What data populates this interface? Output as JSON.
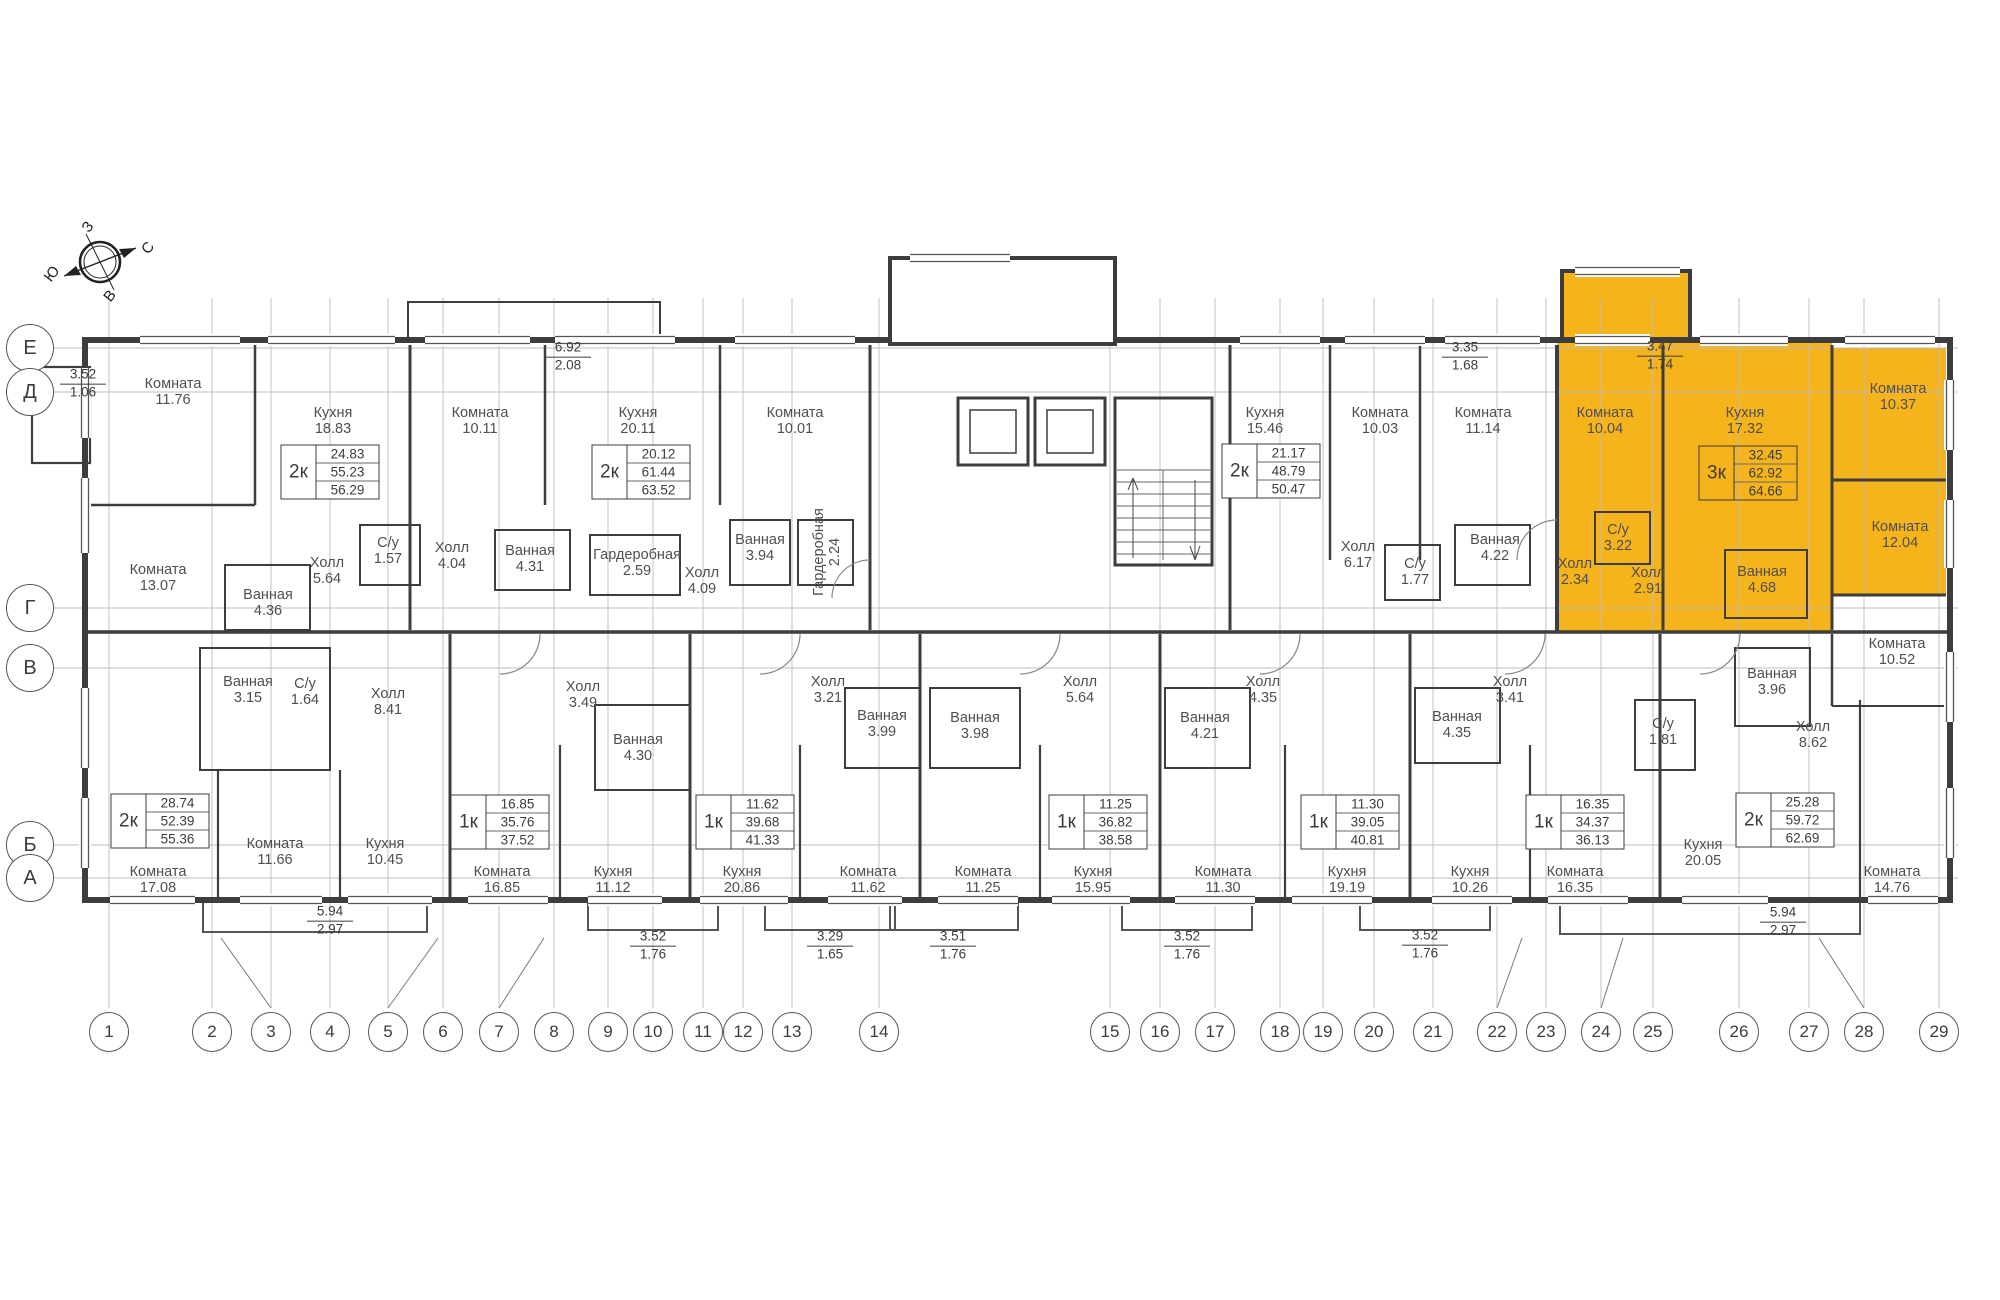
{
  "colors": {
    "highlight": "#F5B41C",
    "wall": "#3D3D3D",
    "grid": "#BDBDBD",
    "text": "#4F4F4F"
  },
  "compass": {
    "top": "З",
    "right": "С",
    "left": "Ю",
    "bottom": "В"
  },
  "row_axes": [
    {
      "label": "Е",
      "y": 348
    },
    {
      "label": "Д",
      "y": 392
    },
    {
      "label": "Г",
      "y": 608
    },
    {
      "label": "В",
      "y": 668
    },
    {
      "label": "Б",
      "y": 845
    },
    {
      "label": "А",
      "y": 878
    }
  ],
  "col_axes": [
    {
      "label": "1",
      "x": 109
    },
    {
      "label": "2",
      "x": 212
    },
    {
      "label": "3",
      "x": 271
    },
    {
      "label": "4",
      "x": 330
    },
    {
      "label": "5",
      "x": 388
    },
    {
      "label": "6",
      "x": 443
    },
    {
      "label": "7",
      "x": 499
    },
    {
      "label": "8",
      "x": 554
    },
    {
      "label": "9",
      "x": 608
    },
    {
      "label": "10",
      "x": 653
    },
    {
      "label": "11",
      "x": 703
    },
    {
      "label": "12",
      "x": 743
    },
    {
      "label": "13",
      "x": 792
    },
    {
      "label": "14",
      "x": 879
    },
    {
      "label": "15",
      "x": 1110
    },
    {
      "label": "16",
      "x": 1160
    },
    {
      "label": "17",
      "x": 1215
    },
    {
      "label": "18",
      "x": 1280
    },
    {
      "label": "19",
      "x": 1323
    },
    {
      "label": "20",
      "x": 1374
    },
    {
      "label": "21",
      "x": 1433
    },
    {
      "label": "22",
      "x": 1497
    },
    {
      "label": "23",
      "x": 1546
    },
    {
      "label": "24",
      "x": 1601
    },
    {
      "label": "25",
      "x": 1653
    },
    {
      "label": "26",
      "x": 1739
    },
    {
      "label": "27",
      "x": 1809
    },
    {
      "label": "28",
      "x": 1864
    },
    {
      "label": "29",
      "x": 1939
    }
  ],
  "rooms": [
    {
      "n": "Комната",
      "a": "11.76",
      "x": 173,
      "y": 392
    },
    {
      "n": "Кухня",
      "a": "18.83",
      "x": 333,
      "y": 421
    },
    {
      "n": "Комната",
      "a": "10.11",
      "x": 480,
      "y": 421
    },
    {
      "n": "Кухня",
      "a": "20.11",
      "x": 638,
      "y": 421
    },
    {
      "n": "Комната",
      "a": "10.01",
      "x": 795,
      "y": 421
    },
    {
      "n": "Кухня",
      "a": "15.46",
      "x": 1265,
      "y": 421
    },
    {
      "n": "Комната",
      "a": "10.03",
      "x": 1380,
      "y": 421
    },
    {
      "n": "Комната",
      "a": "11.14",
      "x": 1483,
      "y": 421
    },
    {
      "n": "Комната",
      "a": "10.04",
      "x": 1605,
      "y": 421,
      "hl": true
    },
    {
      "n": "Кухня",
      "a": "17.32",
      "x": 1745,
      "y": 421,
      "hl": true
    },
    {
      "n": "Комната",
      "a": "10.37",
      "x": 1898,
      "y": 397,
      "hl": true
    },
    {
      "n": "Комната",
      "a": "13.07",
      "x": 158,
      "y": 578
    },
    {
      "n": "Ванная",
      "a": "4.36",
      "x": 268,
      "y": 603
    },
    {
      "n": "Холл",
      "a": "5.64",
      "x": 327,
      "y": 571
    },
    {
      "n": "С/у",
      "a": "1.57",
      "x": 388,
      "y": 551
    },
    {
      "n": "Холл",
      "a": "4.04",
      "x": 452,
      "y": 556
    },
    {
      "n": "Ванная",
      "a": "4.31",
      "x": 530,
      "y": 559
    },
    {
      "n": "Гардеробная",
      "a": "2.59",
      "x": 637,
      "y": 563
    },
    {
      "n": "Холл",
      "a": "4.09",
      "x": 702,
      "y": 581
    },
    {
      "n": "Ванная",
      "a": "3.94",
      "x": 760,
      "y": 548
    },
    {
      "n": "Гардеробная",
      "a": "2.24",
      "x": 827,
      "y": 552,
      "rot": true
    },
    {
      "n": "Холл",
      "a": "6.17",
      "x": 1358,
      "y": 555
    },
    {
      "n": "С/у",
      "a": "1.77",
      "x": 1415,
      "y": 572
    },
    {
      "n": "Ванная",
      "a": "4.22",
      "x": 1495,
      "y": 548
    },
    {
      "n": "Холл",
      "a": "2.34",
      "x": 1575,
      "y": 572,
      "hl": true
    },
    {
      "n": "С/у",
      "a": "3.22",
      "x": 1618,
      "y": 538,
      "hl": true
    },
    {
      "n": "Холл",
      "a": "2.91",
      "x": 1648,
      "y": 581,
      "hl": true
    },
    {
      "n": "Ванная",
      "a": "4.68",
      "x": 1762,
      "y": 580,
      "hl": true
    },
    {
      "n": "Комната",
      "a": "12.04",
      "x": 1900,
      "y": 535,
      "hl": true
    },
    {
      "n": "Комната",
      "a": "10.52",
      "x": 1897,
      "y": 652
    },
    {
      "n": "Ванная",
      "a": "3.15",
      "x": 248,
      "y": 690
    },
    {
      "n": "С/у",
      "a": "1.64",
      "x": 305,
      "y": 692
    },
    {
      "n": "Холл",
      "a": "8.41",
      "x": 388,
      "y": 702
    },
    {
      "n": "Холл",
      "a": "3.49",
      "x": 583,
      "y": 695
    },
    {
      "n": "Ванная",
      "a": "4.30",
      "x": 638,
      "y": 748
    },
    {
      "n": "Холл",
      "a": "3.21",
      "x": 828,
      "y": 690
    },
    {
      "n": "Ванная",
      "a": "3.99",
      "x": 882,
      "y": 724
    },
    {
      "n": "Ванная",
      "a": "3.98",
      "x": 975,
      "y": 726
    },
    {
      "n": "Холл",
      "a": "5.64",
      "x": 1080,
      "y": 690
    },
    {
      "n": "Ванная",
      "a": "4.21",
      "x": 1205,
      "y": 726
    },
    {
      "n": "Холл",
      "a": "4.35",
      "x": 1263,
      "y": 690
    },
    {
      "n": "Ванная",
      "a": "4.35",
      "x": 1457,
      "y": 725
    },
    {
      "n": "Холл",
      "a": "3.41",
      "x": 1510,
      "y": 690
    },
    {
      "n": "С/у",
      "a": "1.81",
      "x": 1663,
      "y": 732
    },
    {
      "n": "Ванная",
      "a": "3.96",
      "x": 1772,
      "y": 682
    },
    {
      "n": "Холл",
      "a": "8.62",
      "x": 1813,
      "y": 735
    },
    {
      "n": "Комната",
      "a": "17.08",
      "x": 158,
      "y": 880
    },
    {
      "n": "Комната",
      "a": "11.66",
      "x": 275,
      "y": 852
    },
    {
      "n": "Кухня",
      "a": "10.45",
      "x": 385,
      "y": 852
    },
    {
      "n": "Комната",
      "a": "16.85",
      "x": 502,
      "y": 880
    },
    {
      "n": "Кухня",
      "a": "11.12",
      "x": 613,
      "y": 880
    },
    {
      "n": "Кухня",
      "a": "20.86",
      "x": 742,
      "y": 880
    },
    {
      "n": "Комната",
      "a": "11.62",
      "x": 868,
      "y": 880
    },
    {
      "n": "Комната",
      "a": "11.25",
      "x": 983,
      "y": 880
    },
    {
      "n": "Кухня",
      "a": "15.95",
      "x": 1093,
      "y": 880
    },
    {
      "n": "Комната",
      "a": "11.30",
      "x": 1223,
      "y": 880
    },
    {
      "n": "Кухня",
      "a": "19.19",
      "x": 1347,
      "y": 880
    },
    {
      "n": "Кухня",
      "a": "10.26",
      "x": 1470,
      "y": 880
    },
    {
      "n": "Комната",
      "a": "16.35",
      "x": 1575,
      "y": 880
    },
    {
      "n": "Кухня",
      "a": "20.05",
      "x": 1703,
      "y": 853
    },
    {
      "n": "Комната",
      "a": "14.76",
      "x": 1892,
      "y": 880
    }
  ],
  "tables": [
    {
      "type": "2к",
      "values": [
        "24.83",
        "55.23",
        "56.29"
      ],
      "x": 330,
      "y": 472
    },
    {
      "type": "2к",
      "values": [
        "20.12",
        "61.44",
        "63.52"
      ],
      "x": 641,
      "y": 472
    },
    {
      "type": "2к",
      "values": [
        "21.17",
        "48.79",
        "50.47"
      ],
      "x": 1271,
      "y": 471
    },
    {
      "type": "3к",
      "values": [
        "32.45",
        "62.92",
        "64.66"
      ],
      "x": 1748,
      "y": 473,
      "hl": true
    },
    {
      "type": "2к",
      "values": [
        "28.74",
        "52.39",
        "55.36"
      ],
      "x": 160,
      "y": 821
    },
    {
      "type": "1к",
      "values": [
        "16.85",
        "35.76",
        "37.52"
      ],
      "x": 500,
      "y": 822
    },
    {
      "type": "1к",
      "values": [
        "11.62",
        "39.68",
        "41.33"
      ],
      "x": 745,
      "y": 822
    },
    {
      "type": "1к",
      "values": [
        "11.25",
        "36.82",
        "38.58"
      ],
      "x": 1098,
      "y": 822
    },
    {
      "type": "1к",
      "values": [
        "11.30",
        "39.05",
        "40.81"
      ],
      "x": 1350,
      "y": 822
    },
    {
      "type": "1к",
      "values": [
        "16.35",
        "34.37",
        "36.13"
      ],
      "x": 1575,
      "y": 822
    },
    {
      "type": "2к",
      "values": [
        "25.28",
        "59.72",
        "62.69"
      ],
      "x": 1785,
      "y": 820
    }
  ],
  "dims": [
    {
      "a": "3.52",
      "b": "1.06",
      "x": 83,
      "y": 384
    },
    {
      "a": "6.92",
      "b": "2.08",
      "x": 568,
      "y": 357
    },
    {
      "a": "3.35",
      "b": "1.68",
      "x": 1465,
      "y": 357
    },
    {
      "a": "3.47",
      "b": "1.74",
      "x": 1660,
      "y": 356
    },
    {
      "a": "5.94",
      "b": "2.97",
      "x": 330,
      "y": 921
    },
    {
      "a": "3.52",
      "b": "1.76",
      "x": 653,
      "y": 946
    },
    {
      "a": "3.29",
      "b": "1.65",
      "x": 830,
      "y": 946
    },
    {
      "a": "3.51",
      "b": "1.76",
      "x": 953,
      "y": 946
    },
    {
      "a": "3.52",
      "b": "1.76",
      "x": 1187,
      "y": 946
    },
    {
      "a": "3.52",
      "b": "1.76",
      "x": 1425,
      "y": 945
    },
    {
      "a": "5.94",
      "b": "2.97",
      "x": 1783,
      "y": 922
    }
  ]
}
